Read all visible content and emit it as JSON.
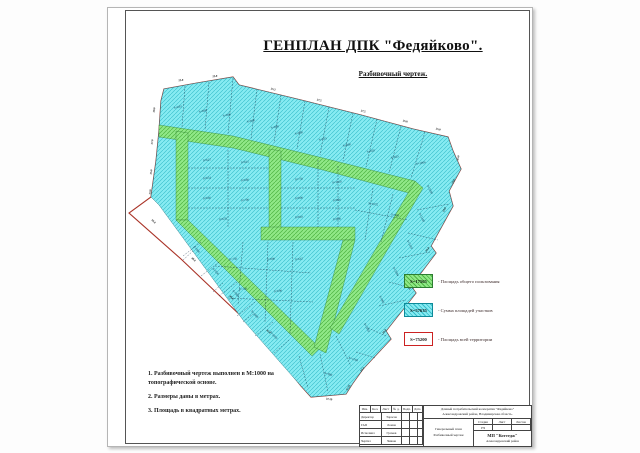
{
  "page": {
    "title": "ГЕНПЛАН ДПК \"Федяйково\".",
    "subtitle": "Разбивочный чертеж."
  },
  "colors": {
    "plot_fill": "#86ebf2",
    "plot_hatch": "#35bcc9",
    "road_fill": "#90e887",
    "road_hatch": "#4db342",
    "boundary": "#a93226",
    "legend_red_border": "#cc2222"
  },
  "legend": {
    "items": [
      {
        "value": "S=17565",
        "label": "- Площадь общего пользования",
        "swatch": "green-hatch"
      },
      {
        "value": "S=57635",
        "label": "- Сумма площадей участков",
        "swatch": "cyan-hatch"
      },
      {
        "value": "S=75200",
        "label": "- Площадь всей территории",
        "swatch": "red-outline"
      }
    ]
  },
  "notes": [
    "1. Разбивочный чертеж выполнен в М:1000 на топографической основе.",
    "2. Размеры даны в метрах.",
    "3. Площадь в квадратных метрах."
  ],
  "title_block": {
    "header_cols": [
      "Изм.",
      "Кол.",
      "Лист",
      "№ д.",
      "Подп.",
      "Дата"
    ],
    "rows": [
      [
        "Директор",
        "Тарасов"
      ],
      [
        "ГАП",
        "Ломов"
      ],
      [
        "Исполнил",
        "Громов"
      ],
      [
        "Чертил",
        "Чижов"
      ]
    ],
    "project_line1": "Дачный потребительский кооператив \"Федяйково\"",
    "project_line2": "Александровский район, Владимирская область.",
    "stage_label": "Стадия",
    "sheet_label": "Лист",
    "sheets_label": "Листов",
    "stage_value": "РЧ",
    "doc_line1": "Генеральный план",
    "doc_line2": "Разбивочный чертеж",
    "org_line1": "МП \"Коттедж\"",
    "org_line2": "Александровский район"
  },
  "map": {
    "plot_labels": [
      [
        55,
        38,
        -12,
        "S=693"
      ],
      [
        80,
        42,
        -12,
        "S=800"
      ],
      [
        104,
        46,
        -12,
        "S=800"
      ],
      [
        128,
        52,
        -12,
        "S=800"
      ],
      [
        152,
        58,
        -12,
        "S=800"
      ],
      [
        176,
        64,
        -12,
        "S=800"
      ],
      [
        200,
        70,
        -12,
        "S=815"
      ],
      [
        224,
        76,
        -12,
        "S=800"
      ],
      [
        248,
        82,
        -12,
        "S=820"
      ],
      [
        272,
        88,
        -12,
        "S=825"
      ],
      [
        298,
        94,
        -12,
        "S=1006"
      ],
      [
        84,
        91,
        -6,
        "S=627"
      ],
      [
        122,
        93,
        -6,
        "S=615"
      ],
      [
        84,
        109,
        -6,
        "S=654"
      ],
      [
        122,
        111,
        -6,
        "S=660"
      ],
      [
        84,
        129,
        -6,
        "S=640"
      ],
      [
        122,
        131,
        -6,
        "S=700"
      ],
      [
        100,
        150,
        -6,
        "S=678"
      ],
      [
        176,
        110,
        -6,
        "S=750"
      ],
      [
        214,
        113,
        -6,
        "S=1050"
      ],
      [
        176,
        129,
        -6,
        "S=800"
      ],
      [
        214,
        131,
        -6,
        "S=820"
      ],
      [
        176,
        148,
        -6,
        "S=810"
      ],
      [
        214,
        150,
        -6,
        "S=800"
      ],
      [
        250,
        135,
        10,
        "S=1075"
      ],
      [
        272,
        146,
        10,
        "S=900"
      ],
      [
        306,
        120,
        62,
        "S=1040"
      ],
      [
        298,
        148,
        62,
        "S=1140"
      ],
      [
        286,
        175,
        62,
        "S=1129"
      ],
      [
        272,
        202,
        62,
        "S=1004"
      ],
      [
        258,
        230,
        62,
        "S=960"
      ],
      [
        243,
        258,
        62,
        "S=1003"
      ],
      [
        230,
        290,
        18,
        "S=1260"
      ],
      [
        205,
        305,
        18,
        "S=900"
      ],
      [
        110,
        190,
        -5,
        "S=750"
      ],
      [
        148,
        190,
        -5,
        "S=800"
      ],
      [
        176,
        190,
        -5,
        "S=647"
      ],
      [
        120,
        220,
        -5,
        "S=720"
      ],
      [
        155,
        222,
        -5,
        "S=690"
      ],
      [
        73,
        180,
        48,
        "S=900"
      ],
      [
        92,
        202,
        48,
        "S=950"
      ],
      [
        112,
        224,
        48,
        "S=980"
      ],
      [
        131,
        245,
        48,
        "S=1000"
      ],
      [
        150,
        266,
        48,
        "S=1050"
      ]
    ],
    "dim_labels": [
      [
        32,
        40,
        -85,
        "29.0"
      ],
      [
        30,
        72,
        -85,
        "27.0"
      ],
      [
        29,
        102,
        -85,
        "25.0"
      ],
      [
        28,
        122,
        -85,
        "23.0"
      ],
      [
        58,
        11,
        -6,
        "25.0"
      ],
      [
        92,
        7,
        -6,
        "25.0"
      ],
      [
        150,
        20,
        13,
        "35.2"
      ],
      [
        196,
        31,
        13,
        "27.5"
      ],
      [
        240,
        42,
        13,
        "27.5"
      ],
      [
        282,
        52,
        13,
        "25.8"
      ],
      [
        315,
        60,
        13,
        "35.0"
      ],
      [
        336,
        88,
        -80,
        "35.0"
      ],
      [
        331,
        112,
        -62,
        "25.0"
      ],
      [
        322,
        140,
        -62,
        "25.0"
      ],
      [
        305,
        180,
        -52,
        "25.0"
      ],
      [
        288,
        218,
        -52,
        "24.0"
      ],
      [
        262,
        262,
        -52,
        "25.0"
      ],
      [
        240,
        300,
        -50,
        "17.2"
      ],
      [
        206,
        330,
        8,
        "37.29"
      ],
      [
        226,
        318,
        -62,
        "17.25"
      ],
      [
        30,
        152,
        42,
        "50.0"
      ],
      [
        70,
        190,
        42,
        "48.0"
      ],
      [
        108,
        228,
        42,
        "46.0"
      ],
      [
        145,
        262,
        42,
        "42.0"
      ]
    ]
  }
}
